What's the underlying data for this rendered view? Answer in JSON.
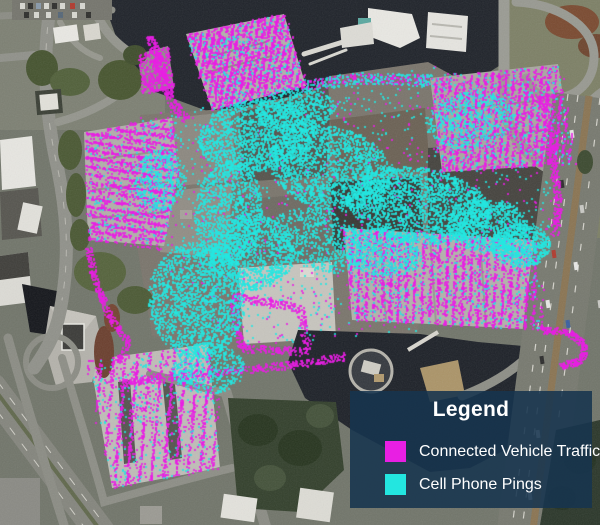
{
  "legend": {
    "title": "Legend",
    "panel_color": "rgba(23,52,79,0.88)",
    "text_color": "#ffffff",
    "items": [
      {
        "id": "connected-vehicle-traffic",
        "label": "Connected Vehicle Traffic",
        "color": "#e81fe3"
      },
      {
        "id": "cell-phone-pings",
        "label": "Cell Phone Pings",
        "color": "#23e6e0"
      }
    ]
  },
  "map": {
    "type": "satellite-imagery-with-point-overlay",
    "series": [
      {
        "key": "cv",
        "name": "Connected Vehicle Traffic",
        "color": "#e81fe3"
      },
      {
        "key": "cpp",
        "name": "Cell Phone Pings",
        "color": "#23e6e0"
      }
    ],
    "dot_size": 2,
    "dot_alpha": 0.82,
    "clusters": [
      {
        "series": "cv",
        "type": "poly",
        "pts": [
          [
            186,
            34
          ],
          [
            284,
            14
          ],
          [
            306,
            86
          ],
          [
            212,
            110
          ]
        ],
        "count": 2200,
        "rows": [
          100,
          6
        ]
      },
      {
        "series": "cpp",
        "type": "poly",
        "pts": [
          [
            186,
            34
          ],
          [
            284,
            14
          ],
          [
            306,
            86
          ],
          [
            212,
            110
          ]
        ],
        "count": 260
      },
      {
        "series": "cv",
        "type": "poly",
        "pts": [
          [
            138,
            54
          ],
          [
            168,
            46
          ],
          [
            174,
            88
          ],
          [
            142,
            94
          ]
        ],
        "count": 320
      },
      {
        "series": "cv",
        "type": "poly",
        "pts": [
          [
            430,
            78
          ],
          [
            558,
            64
          ],
          [
            574,
            164
          ],
          [
            442,
            172
          ]
        ],
        "count": 2400,
        "rows": [
          95,
          7
        ]
      },
      {
        "series": "cpp",
        "type": "poly",
        "pts": [
          [
            430,
            78
          ],
          [
            558,
            64
          ],
          [
            574,
            164
          ],
          [
            442,
            172
          ]
        ],
        "count": 280
      },
      {
        "series": "cv",
        "type": "poly",
        "pts": [
          [
            84,
            132
          ],
          [
            172,
            118
          ],
          [
            178,
            172
          ],
          [
            164,
            246
          ],
          [
            88,
            240
          ]
        ],
        "count": 2100,
        "rows": [
          8,
          8
        ]
      },
      {
        "series": "cpp",
        "type": "poly",
        "pts": [
          [
            84,
            132
          ],
          [
            172,
            118
          ],
          [
            178,
            172
          ],
          [
            164,
            246
          ],
          [
            88,
            240
          ]
        ],
        "count": 170
      },
      {
        "series": "cv",
        "type": "poly",
        "pts": [
          [
            90,
            360
          ],
          [
            208,
            344
          ],
          [
            220,
            468
          ],
          [
            112,
            488
          ]
        ],
        "count": 1500,
        "rows": [
          95,
          12
        ]
      },
      {
        "series": "cpp",
        "type": "poly",
        "pts": [
          [
            90,
            360
          ],
          [
            208,
            344
          ],
          [
            220,
            468
          ],
          [
            112,
            488
          ]
        ],
        "count": 220
      },
      {
        "series": "cv",
        "type": "poly",
        "pts": [
          [
            344,
            228
          ],
          [
            534,
            240
          ],
          [
            544,
            330
          ],
          [
            352,
            320
          ]
        ],
        "count": 2700,
        "rows": [
          92,
          8
        ]
      },
      {
        "series": "cpp",
        "type": "poly",
        "pts": [
          [
            344,
            228
          ],
          [
            534,
            240
          ],
          [
            544,
            330
          ],
          [
            352,
            320
          ]
        ],
        "count": 320
      },
      {
        "series": "cv",
        "type": "poly",
        "pts": [
          [
            140,
            115
          ],
          [
            310,
            92
          ],
          [
            428,
            64
          ],
          [
            545,
            100
          ],
          [
            552,
            232
          ],
          [
            425,
            250
          ],
          [
            418,
            330
          ],
          [
            232,
            348
          ],
          [
            138,
            240
          ]
        ],
        "count": 600
      },
      {
        "series": "cpp",
        "type": "poly",
        "pts": [
          [
            140,
            115
          ],
          [
            310,
            92
          ],
          [
            428,
            64
          ],
          [
            545,
            100
          ],
          [
            552,
            232
          ],
          [
            425,
            250
          ],
          [
            418,
            330
          ],
          [
            232,
            348
          ],
          [
            138,
            240
          ]
        ],
        "count": 900
      },
      {
        "series": "cv",
        "type": "band",
        "pts": [
          [
            150,
            36
          ],
          [
            162,
            72
          ],
          [
            172,
            102
          ],
          [
            186,
            120
          ]
        ],
        "w": 9,
        "count": 280
      },
      {
        "series": "cv",
        "type": "band",
        "pts": [
          [
            88,
            248
          ],
          [
            96,
            284
          ],
          [
            110,
            318
          ],
          [
            128,
            342
          ],
          [
            118,
            362
          ]
        ],
        "w": 7,
        "count": 300
      },
      {
        "series": "cv",
        "type": "band",
        "pts": [
          [
            232,
            296
          ],
          [
            300,
            308
          ],
          [
            308,
            352
          ],
          [
            242,
            348
          ],
          [
            232,
            298
          ]
        ],
        "w": 8,
        "count": 430
      },
      {
        "series": "cv",
        "type": "band",
        "pts": [
          [
            544,
            96
          ],
          [
            552,
            150
          ],
          [
            558,
            205
          ],
          [
            554,
            236
          ]
        ],
        "w": 8,
        "count": 320
      },
      {
        "series": "cv",
        "type": "band",
        "pts": [
          [
            300,
            86
          ],
          [
            360,
            78
          ],
          [
            430,
            80
          ]
        ],
        "w": 10,
        "count": 240
      },
      {
        "series": "cv",
        "type": "band",
        "pts": [
          [
            540,
            330
          ],
          [
            568,
            332
          ],
          [
            584,
            344
          ],
          [
            582,
            360
          ],
          [
            560,
            366
          ]
        ],
        "w": 7,
        "count": 300
      },
      {
        "series": "cv",
        "type": "band",
        "pts": [
          [
            120,
            382
          ],
          [
            215,
            372
          ],
          [
            300,
            364
          ],
          [
            345,
            356
          ]
        ],
        "w": 8,
        "count": 420
      },
      {
        "series": "cpp",
        "type": "band",
        "pts": [
          [
            300,
            86
          ],
          [
            360,
            78
          ],
          [
            430,
            80
          ]
        ],
        "w": 12,
        "count": 200
      },
      {
        "series": "cpp",
        "type": "ellipse",
        "cx": 255,
        "cy": 135,
        "rx": 58,
        "ry": 36,
        "rot": -8,
        "count": 1500
      },
      {
        "series": "cpp",
        "type": "ellipse",
        "cx": 330,
        "cy": 168,
        "rx": 62,
        "ry": 42,
        "rot": 12,
        "count": 1800
      },
      {
        "series": "cpp",
        "type": "ellipse",
        "cx": 418,
        "cy": 205,
        "rx": 72,
        "ry": 38,
        "rot": 8,
        "count": 2000
      },
      {
        "series": "cpp",
        "type": "ellipse",
        "cx": 487,
        "cy": 225,
        "rx": 40,
        "ry": 26,
        "rot": 0,
        "count": 800
      },
      {
        "series": "cpp",
        "type": "ellipse",
        "cx": 520,
        "cy": 245,
        "rx": 30,
        "ry": 22,
        "rot": 0,
        "count": 650
      },
      {
        "series": "cpp",
        "type": "ellipse",
        "cx": 228,
        "cy": 212,
        "rx": 34,
        "ry": 52,
        "rot": 5,
        "count": 1100
      },
      {
        "series": "cpp",
        "type": "ellipse",
        "cx": 196,
        "cy": 300,
        "rx": 48,
        "ry": 58,
        "rot": -5,
        "count": 1800
      },
      {
        "series": "cpp",
        "type": "ellipse",
        "cx": 252,
        "cy": 252,
        "rx": 42,
        "ry": 38,
        "rot": 0,
        "count": 1000
      },
      {
        "series": "cpp",
        "type": "ellipse",
        "cx": 320,
        "cy": 240,
        "rx": 50,
        "ry": 30,
        "rot": 20,
        "count": 650
      },
      {
        "series": "cpp",
        "type": "ellipse",
        "cx": 382,
        "cy": 252,
        "rx": 40,
        "ry": 24,
        "rot": 10,
        "count": 500
      },
      {
        "series": "cpp",
        "type": "ellipse",
        "cx": 208,
        "cy": 368,
        "rx": 36,
        "ry": 26,
        "rot": 0,
        "count": 450
      },
      {
        "series": "cpp",
        "type": "ellipse",
        "cx": 160,
        "cy": 180,
        "rx": 26,
        "ry": 30,
        "rot": 0,
        "count": 380
      },
      {
        "series": "cpp",
        "type": "ellipse",
        "cx": 295,
        "cy": 110,
        "rx": 40,
        "ry": 22,
        "rot": -5,
        "count": 550
      },
      {
        "series": "cpp",
        "type": "ellipse",
        "cx": 470,
        "cy": 120,
        "rx": 45,
        "ry": 28,
        "rot": -10,
        "count": 480
      }
    ]
  }
}
